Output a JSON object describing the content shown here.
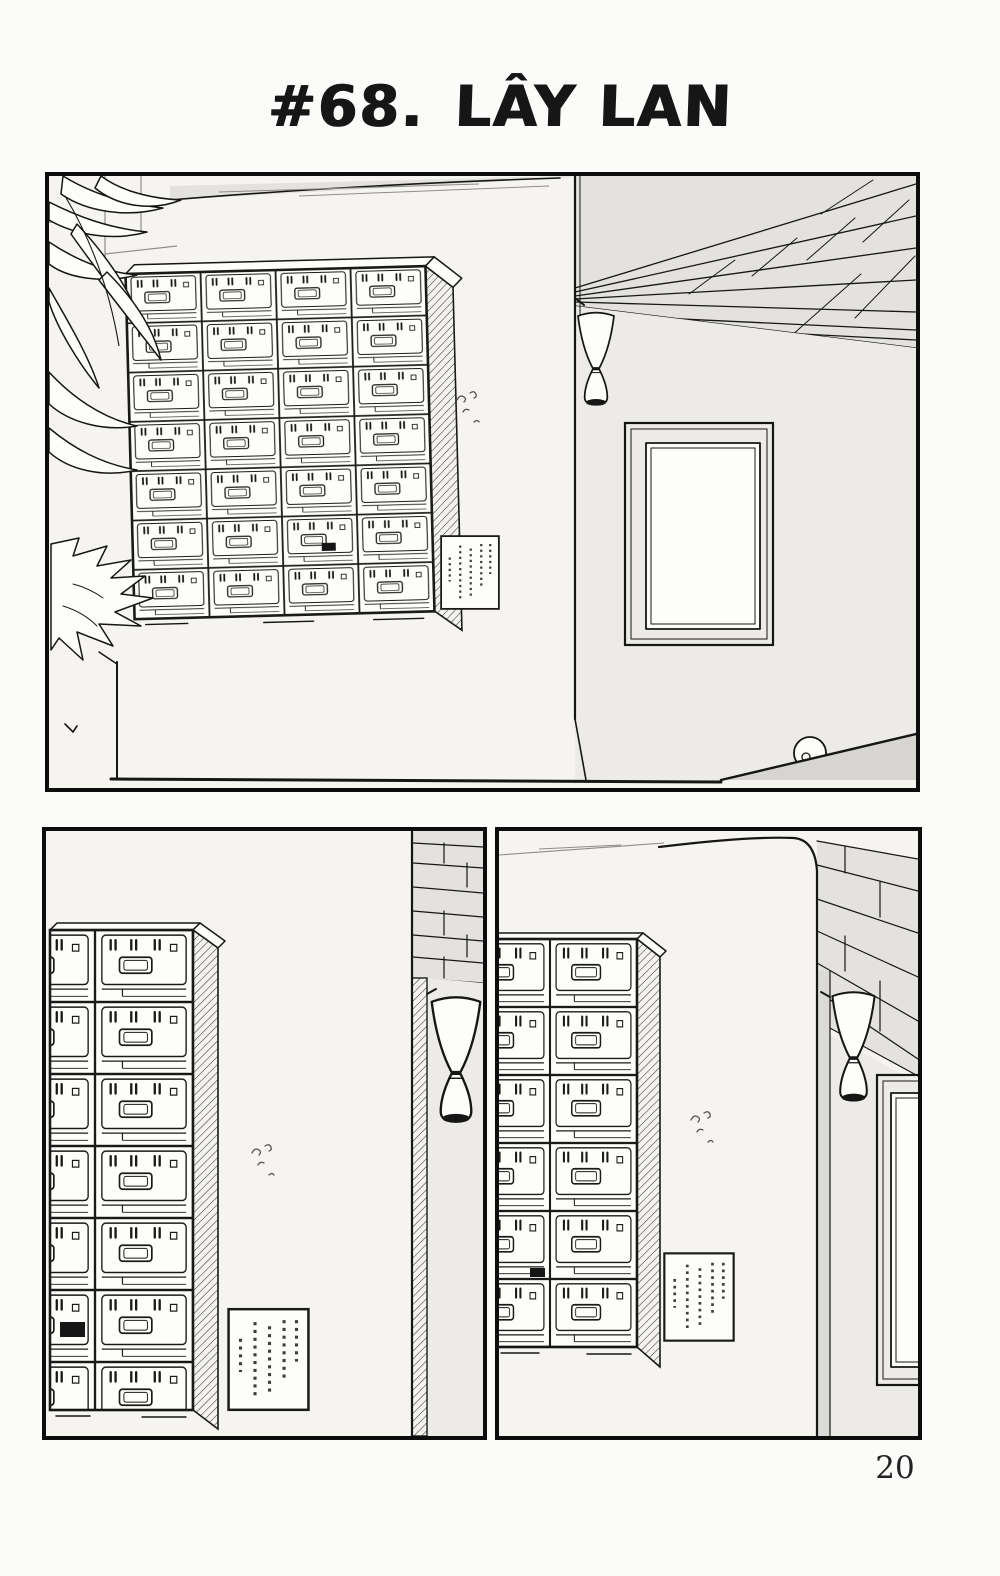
{
  "page": {
    "title_prefix": "#68.",
    "title_text": "LÂY LAN",
    "page_number": "20"
  },
  "colors": {
    "ink": "#161616",
    "paper": "#fbfbf9",
    "wall_light": "#f5f4f0",
    "wall_shade": "#ecebe7",
    "ceiling_shade": "#e3e2de",
    "pillar_shade": "#dbdad6",
    "ramp_shade": "#d6d5d1"
  },
  "panels": [
    {
      "id": "top",
      "elements": [
        "locker-cabinet",
        "potted-plant",
        "wall-lamp",
        "window",
        "notice-sign",
        "ceiling-beams",
        "floor-ramp",
        "round-object",
        "ink-smudge"
      ]
    },
    {
      "id": "bottom-left",
      "elements": [
        "locker-cabinet",
        "notice-sign",
        "ceiling-grid",
        "wall-pillar",
        "wall-lamp",
        "ink-smudge"
      ]
    },
    {
      "id": "bottom-right",
      "elements": [
        "locker-cabinet",
        "notice-sign",
        "ceiling-grid",
        "wall-pillar",
        "wall-lamp",
        "window",
        "ink-smudge"
      ]
    }
  ]
}
